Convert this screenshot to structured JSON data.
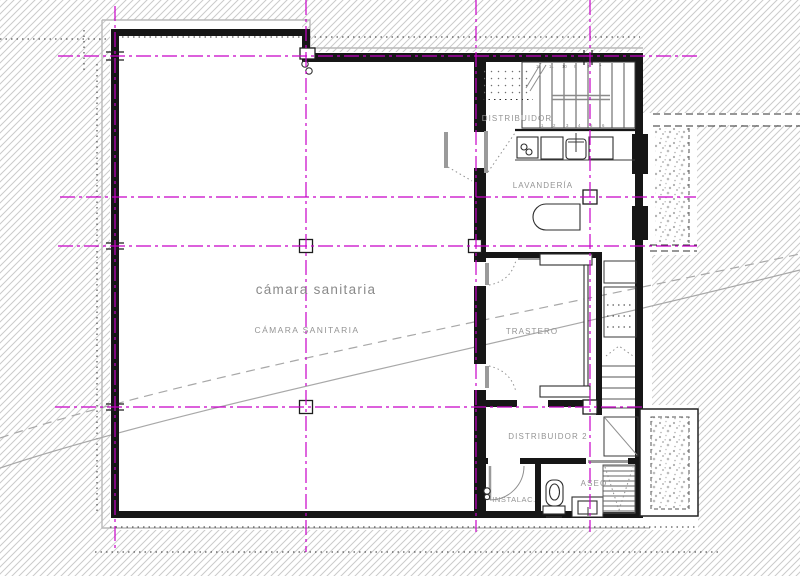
{
  "labels": {
    "camara_title": "cámara sanitaria",
    "camara_caps": "CÁMARA SANITARIA",
    "distribuidor": "DISTRIBUIDOR",
    "lavanderia": "LAVANDERÍA",
    "trastero": "TRASTERO",
    "distribuidor2": "DISTRIBUIDOR 2",
    "aseo": "ASEO",
    "instalac": "INSTALAC."
  },
  "stair_numbers": {
    "upper_flight_top": [
      "12",
      "11",
      "10",
      "9",
      "8",
      "7"
    ],
    "upper_flight_bottom": [
      "1",
      "2",
      "3",
      "4",
      "5",
      "6"
    ]
  },
  "colors": {
    "grid": "#c800c8",
    "hatch": "#c9c9c9",
    "wall": "#161616",
    "label": "#949494",
    "contour": "#a8a8a8",
    "stipple": "#b3b3b3"
  }
}
